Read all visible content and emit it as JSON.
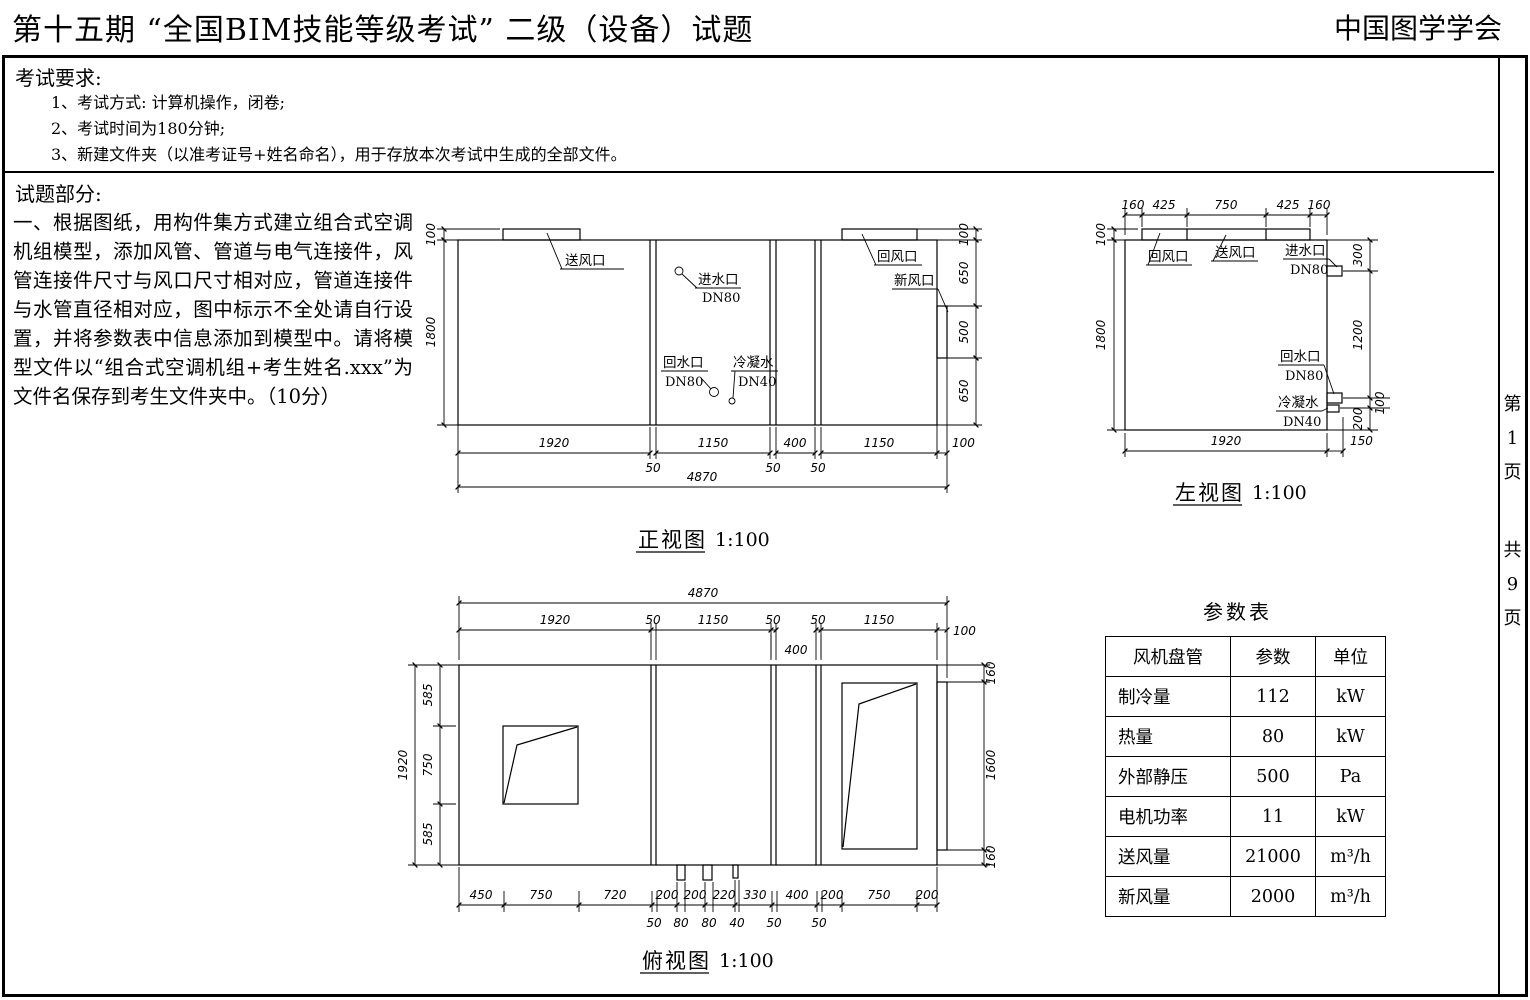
{
  "header": {
    "title": "第十五期 “全国BIM技能等级考试” 二级（设备）试题",
    "org": "中国图学学会"
  },
  "requirements": {
    "heading": "考试要求:",
    "items": [
      "1、考试方式: 计算机操作，闭卷;",
      "2、考试时间为180分钟;",
      "3、新建文件夹（以准考证号+姓名命名），用于存放本次考试中生成的全部文件。"
    ]
  },
  "question": {
    "heading": "试题部分:",
    "body": "一、根据图纸，用构件集方式建立组合式空调机组模型，添加风管、管道与电气连接件，风管连接件尺寸与风口尺寸相对应，管道连接件与水管直径相对应，图中标示不全处请自行设置，并将参数表中信息添加到模型中。请将模型文件以“组合式空调机组+考生姓名.xxx”为文件名保存到考生文件夹中。（10分）"
  },
  "front_view": {
    "title": "正视图",
    "scale": "1:100",
    "labels": {
      "song": "送风口",
      "jin": "进水口",
      "jin_dn": "DN80",
      "hui_feng": "回风口",
      "xin": "新风口",
      "hui_shui": "回水口",
      "hui_shui_dn": "DN80",
      "leng": "冷凝水",
      "leng_dn": "DN40"
    },
    "dims": {
      "left": [
        "100",
        "1800"
      ],
      "right": [
        "100",
        "650",
        "500",
        "650"
      ],
      "chain": [
        "1920",
        "1150",
        "400",
        "1150",
        "100"
      ],
      "chain_small": [
        "50",
        "50",
        "50"
      ],
      "total": "4870"
    }
  },
  "left_view": {
    "title": "左视图",
    "scale": "1:100",
    "labels": {
      "hui_feng": "回风口",
      "song": "送风口",
      "jin": "进水口",
      "jin_dn": "DN80",
      "hui_shui": "回水口",
      "hui_shui_dn": "DN80",
      "leng": "冷凝水",
      "leng_dn": "DN40"
    },
    "dims": {
      "top": [
        "160",
        "425",
        "750",
        "425",
        "160"
      ],
      "left": [
        "100",
        "1800"
      ],
      "right": [
        "300",
        "1200",
        "100",
        "200"
      ],
      "bottom": [
        "1920",
        "150"
      ]
    }
  },
  "top_view": {
    "title": "俯视图",
    "scale": "1:100",
    "dims": {
      "total": "4870",
      "chain": [
        "1920",
        "50",
        "1150",
        "50",
        "50",
        "1150",
        "100"
      ],
      "chain_below": "400",
      "left": [
        "585",
        "750",
        "585"
      ],
      "left_total": "1920",
      "right": [
        "160",
        "1600",
        "160"
      ],
      "bottom": [
        "450",
        "750",
        "720",
        "200",
        "200",
        "220",
        "330",
        "400",
        "200",
        "750",
        "200"
      ],
      "bottom_small": [
        "50",
        "80",
        "80",
        "40",
        "50",
        "50"
      ]
    }
  },
  "param_table": {
    "title": "参数表",
    "headers": [
      "风机盘管",
      "参数",
      "单位"
    ],
    "rows": [
      [
        "制冷量",
        "112",
        "kW"
      ],
      [
        "热量",
        "80",
        "kW"
      ],
      [
        "外部静压",
        "500",
        "Pa"
      ],
      [
        "电机功率",
        "11",
        "kW"
      ],
      [
        "送风量",
        "21000",
        "m³/h"
      ],
      [
        "新风量",
        "2000",
        "m³/h"
      ]
    ]
  },
  "page_indicator": {
    "chars": [
      "第",
      "1",
      "页",
      "共",
      "9",
      "页"
    ]
  }
}
